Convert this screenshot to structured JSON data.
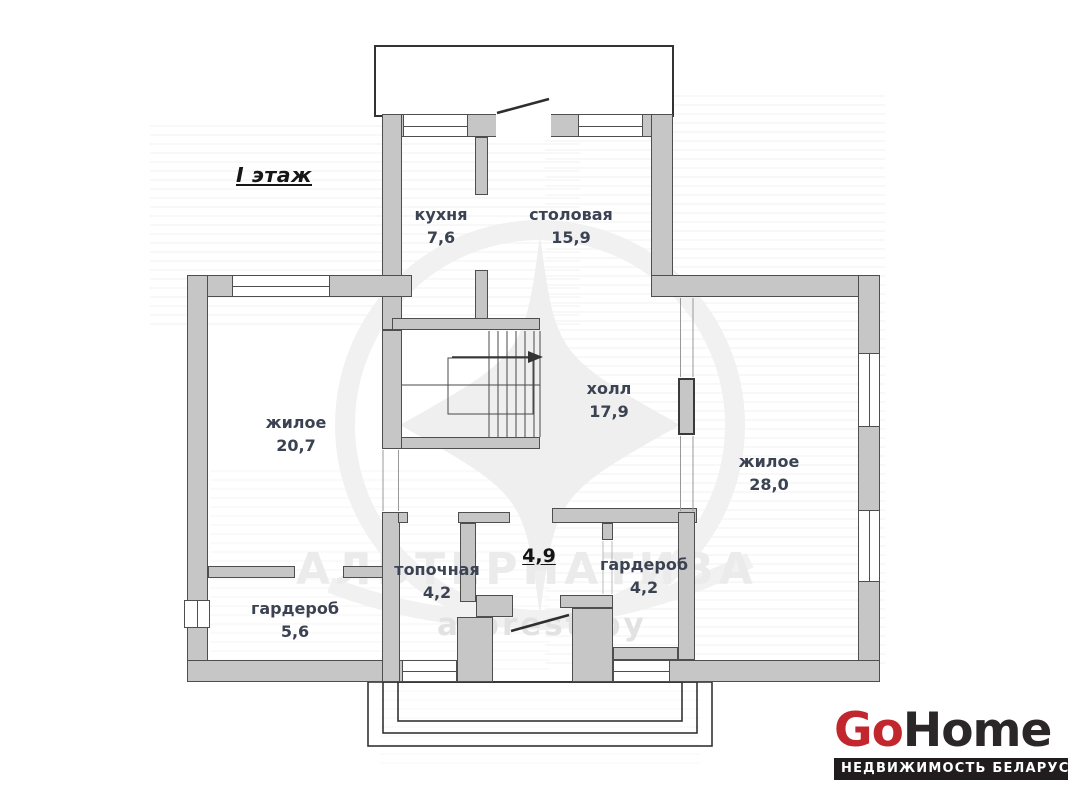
{
  "plan": {
    "title": "I этаж"
  },
  "rooms": [
    {
      "name": "кухня",
      "area": "7,6"
    },
    {
      "name": "столовая",
      "area": "15,9"
    },
    {
      "name": "жилое",
      "area": "20,7"
    },
    {
      "name": "холл",
      "area": "17,9"
    },
    {
      "name": "жилое",
      "area": "28,0"
    },
    {
      "name": "топочная",
      "area": "4,2"
    },
    {
      "name": "",
      "area": "4,9"
    },
    {
      "name": "гардероб",
      "area": "4,2"
    },
    {
      "name": "гардероб",
      "area": "5,6"
    }
  ],
  "watermark": {
    "agency": "АЛЬТЕРНАТИВА",
    "site": "a-brest.by"
  },
  "logo": {
    "part1": "Go",
    "part2": "Home",
    "tagline": "НЕДВИЖИМОСТЬ БЕЛАРУСИ",
    "accent_color": "#c2272d",
    "dark_color": "#2b2728"
  },
  "colors": {
    "wall_fill": "#c6c6c6",
    "wall_edge": "#4e4e4e",
    "label_text": "#3b4252",
    "watermark": "#ebebeb"
  }
}
